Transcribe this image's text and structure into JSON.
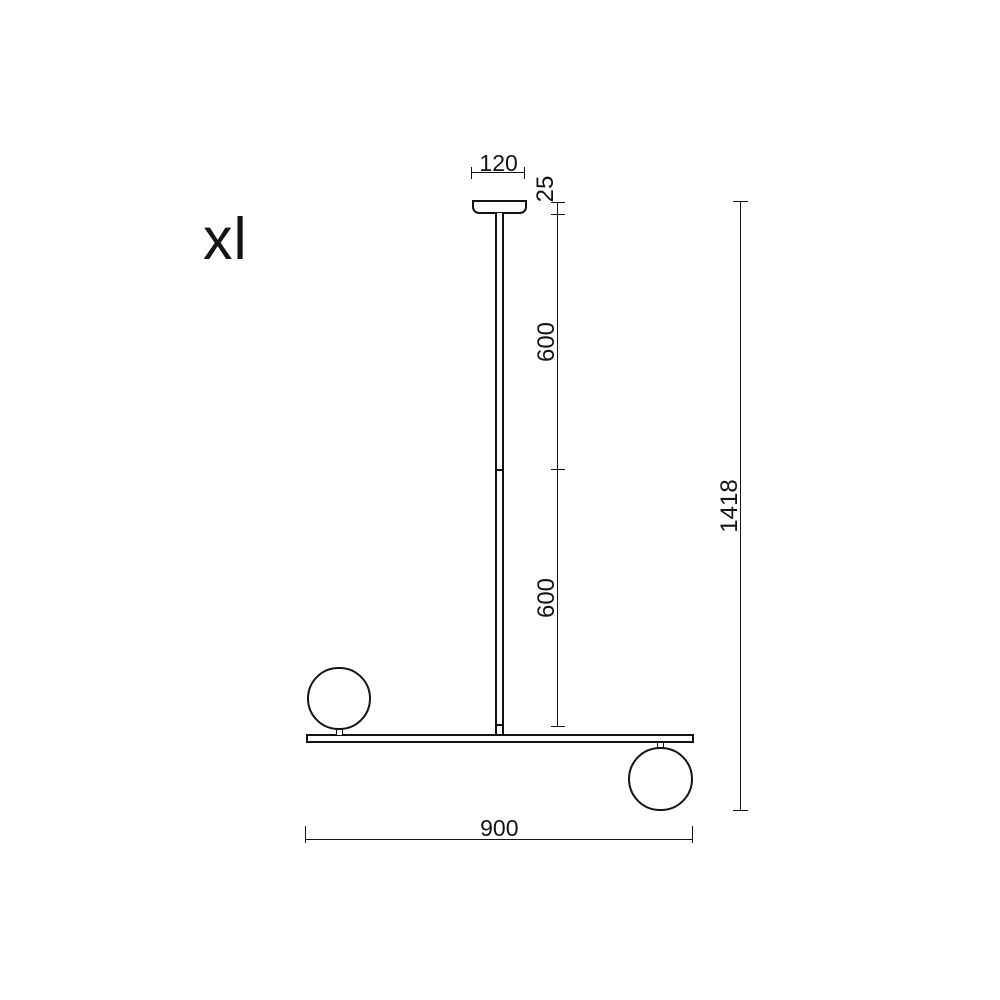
{
  "drawing": {
    "variant_label": "xl",
    "dimensions": {
      "canopy_width_mm": "120",
      "canopy_drop_mm": "25",
      "upper_rod_mm": "600",
      "lower_rod_mm": "600",
      "overall_height_mm": "1418",
      "bar_length_mm": "900"
    },
    "colors": {
      "line": "#141414",
      "background": "#ffffff"
    }
  }
}
